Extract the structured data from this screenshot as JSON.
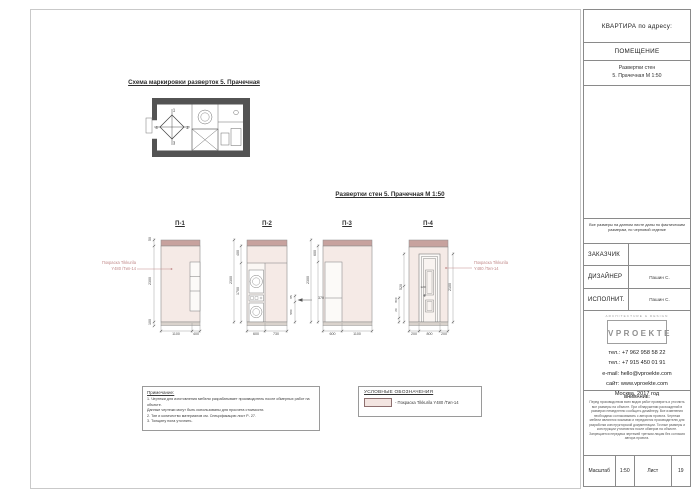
{
  "sheet": {
    "schema_title": "Схема маркировки разверток 5. Прачечная",
    "main_title": "Развертки стен 5. Прачечная М 1:50"
  },
  "plan": {
    "m1": "1",
    "m2": "2",
    "m3": "3",
    "m4": "4"
  },
  "elev": {
    "e1": {
      "label": "П-1",
      "v50": "50",
      "v2300": "2300",
      "v100": "100",
      "h1100": "1100",
      "h400": "400",
      "ann1": "Покраска Tikkurila",
      "ann2": "Y480 /Тип-14"
    },
    "e2": {
      "label": "П-2",
      "v400": "400",
      "v1700": "1700",
      "v2300": "2300",
      "h600": "600",
      "h730": "730",
      "r370": "370",
      "s85": "85",
      "s580": "580"
    },
    "e3": {
      "label": "П-3",
      "v600": "600",
      "v2300": "2300",
      "h600": "600",
      "h1100": "1100"
    },
    "e4": {
      "label": "П-4",
      "v520": "520",
      "v800": "800",
      "v20": "20",
      "v2100": "2100",
      "h200a": "200",
      "h800": "800",
      "h200b": "200",
      "i120": "120",
      "ann1": "Покраска Tikkurila",
      "ann2": "Y480 /Тип-14"
    }
  },
  "notes": {
    "title": "Примечание:",
    "lines": [
      "1. Чертежи для изготовления мебели разрабатывает производитель после обмерных работ на объекте.",
      "Данные чертежи могут быть использованы для просчета стоимости.",
      "2. Тип и количество материалов см. Спецификацию лист Р- 27.",
      "3. Толщину пола уточнить."
    ]
  },
  "legend": {
    "title": "УСЛОВНЫЕ ОБОЗНАЧЕНИЯ",
    "item": "- Покраска Tikkurila Y480 /Тип-14"
  },
  "titleblock": {
    "header": "КВАРТИРА по адресу:",
    "room_header": "ПОМЕЩЕНИЕ",
    "sheet_name1": "Развертки стен",
    "sheet_name2": "5. Прачечная М 1:50",
    "note": "Все размеры на данном листе даны по фактическим размерам, по черновой отделке",
    "customer_label": "ЗАКАЗЧИК",
    "designer_label": "ДИЗАЙНЕР",
    "designer_value": "Пашин С.",
    "executor_label": "ИСПОЛНИТ.",
    "executor_value": "Пашин С.",
    "logo_tagline": "ARCHITECTURE & DESIGN",
    "logo_name": "VPROEKTE",
    "contacts": [
      "тел.: +7 962 958 58 22",
      "тел.: +7 915 450 01 91",
      "e-mail: hello@vproekte.com",
      "сайт: www.vproekte.com",
      "Москва, 2017 год"
    ],
    "warning_title": "ВНИМАНИЕ:",
    "warning_text": "Перед производством всех видов работ проверить и уточнить все размеры на объекте. При обнаружении расхождений в размерах немедленно сообщить дизайнеру. Все изменения необходимо согласовывать с автором проекта. Чертежи мебели являются эскизами и передаются производителю для разработки конструкторской документации. Точные размеры и конструкции уточняются после обмеров на объекте. Запрещается передача чертежей третьим лицам без согласия автора проекта.",
    "footer": {
      "scale_label": "Масштаб",
      "scale": "1:50",
      "sheet_label": "Лист",
      "sheet": "19"
    }
  }
}
